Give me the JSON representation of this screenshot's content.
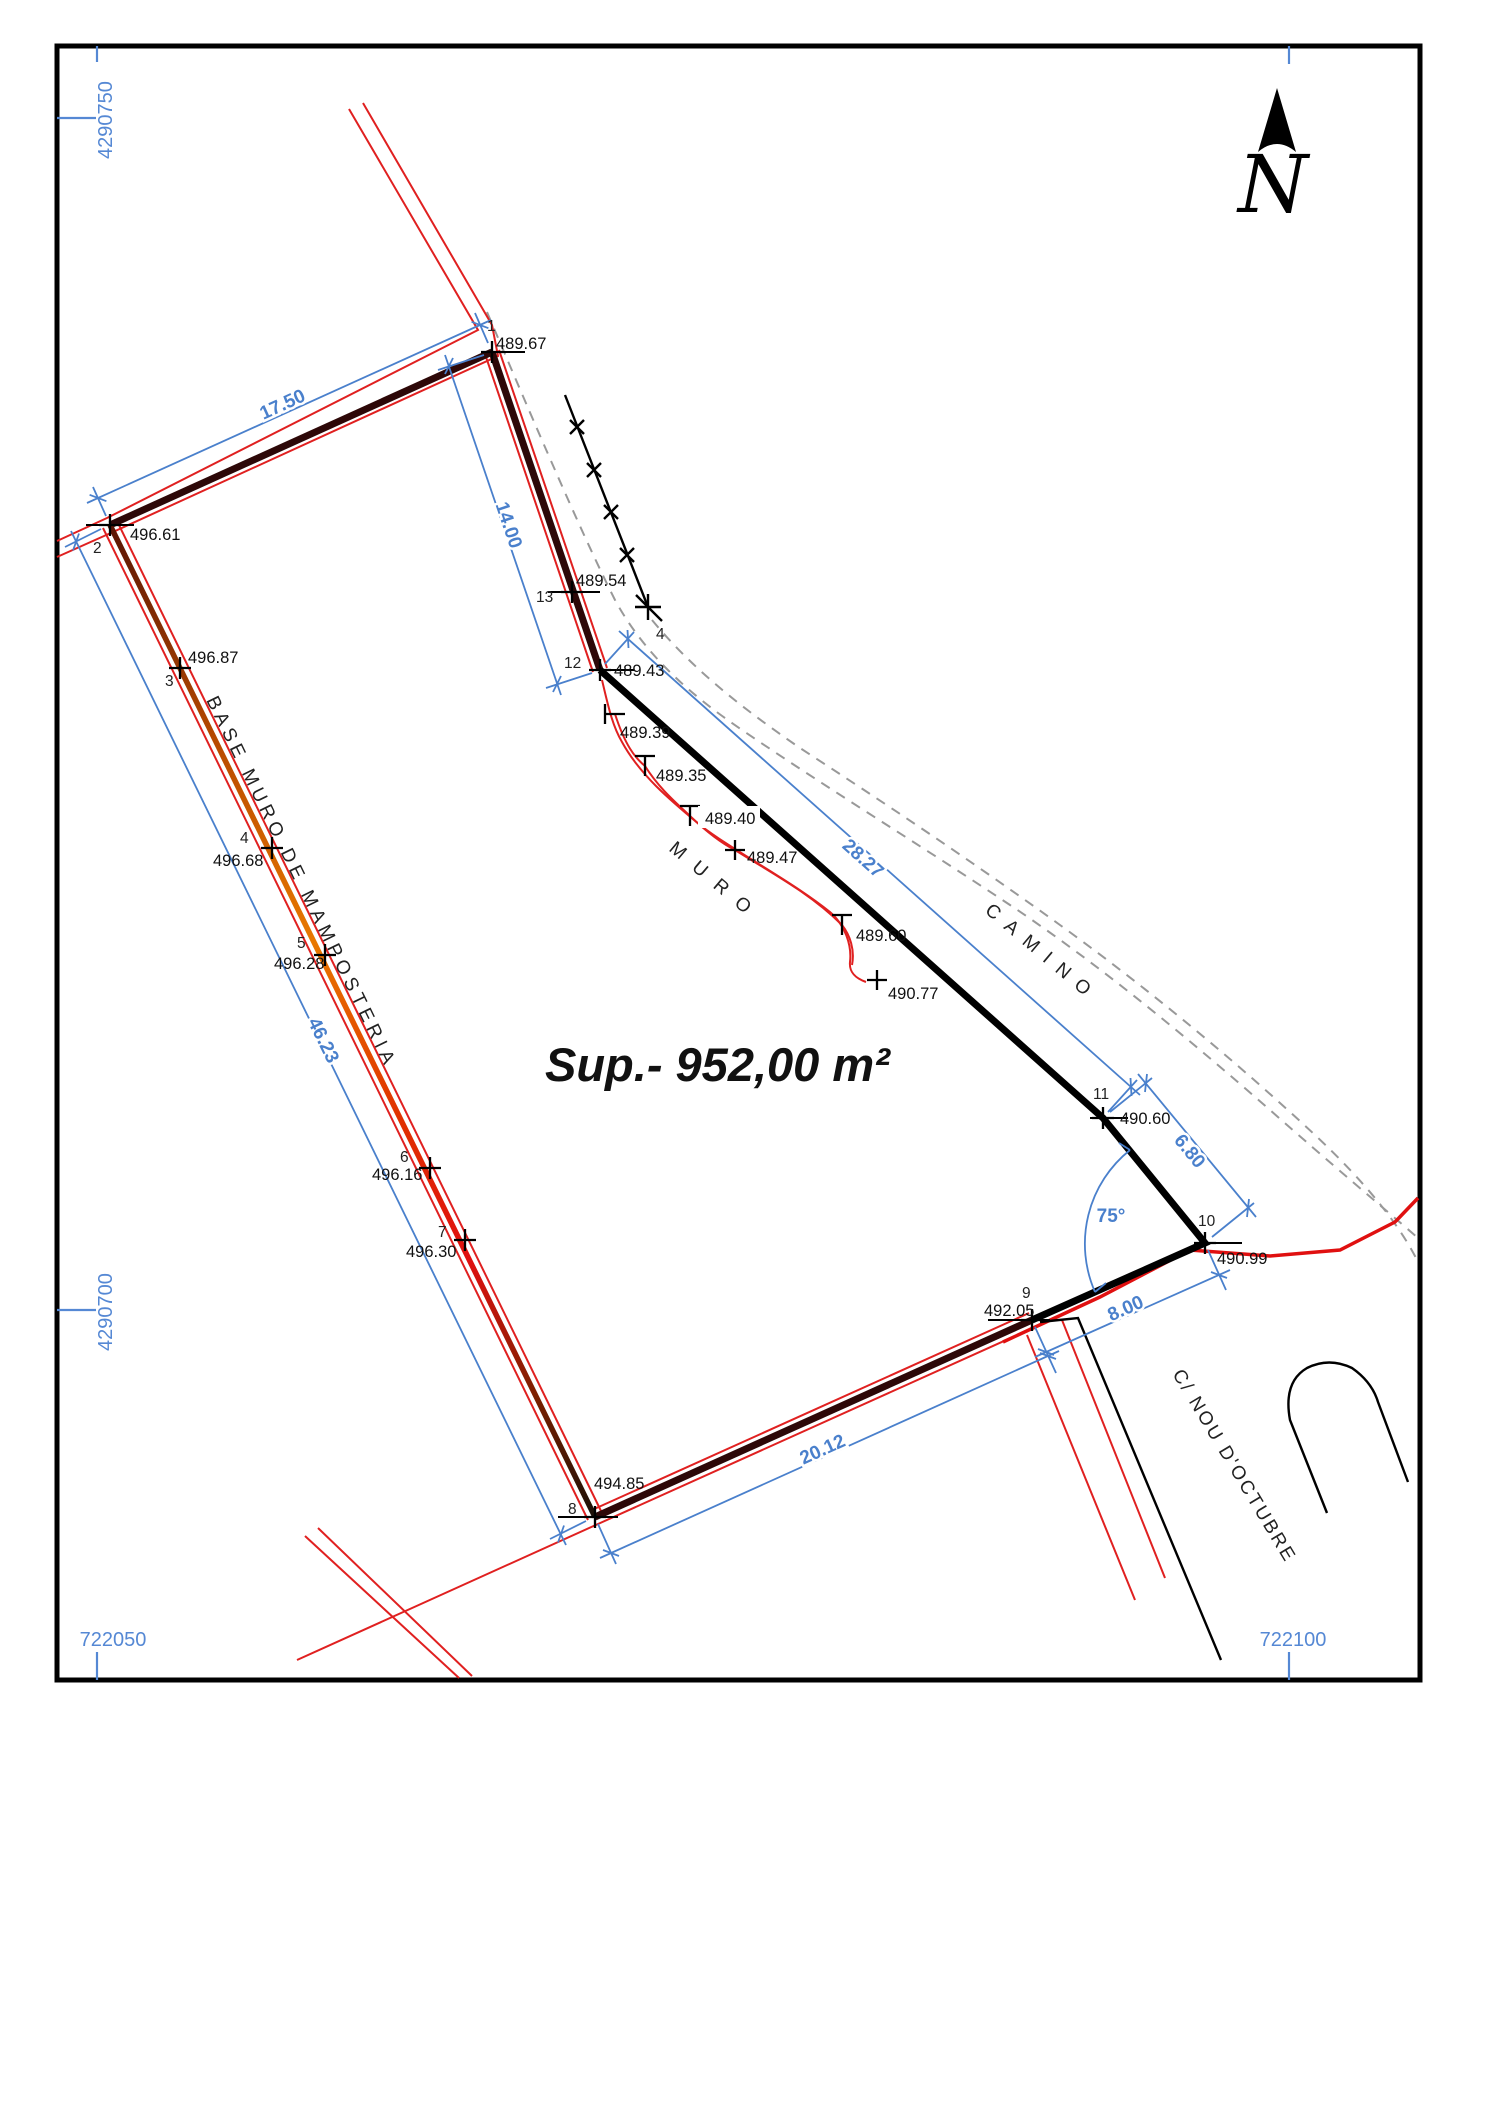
{
  "document": {
    "type": "topographic-survey-plot-plan"
  },
  "grid": {
    "northing_top": "4290750",
    "northing_bottom": "4290700",
    "easting_left": "722050",
    "easting_right": "722100"
  },
  "north_arrow": {
    "label": "N"
  },
  "area": {
    "label": "Sup.- 952,00 m²"
  },
  "labels": {
    "base_muro": "BASE MURO DE MAMPOSTERIA",
    "muro": "MURO",
    "camino": "CAMINO",
    "street": "C/ NOU D'OCTUBRE",
    "angle": "75°"
  },
  "dims": [
    {
      "label": "17.50"
    },
    {
      "label": "14.00"
    },
    {
      "label": "46.23"
    },
    {
      "label": "20.12"
    },
    {
      "label": "8.00"
    },
    {
      "label": "28.27"
    },
    {
      "label": "6.80"
    }
  ],
  "points": [
    {
      "id": "1",
      "elev": "489.67"
    },
    {
      "id": "2",
      "elev": "496.61"
    },
    {
      "id": "3",
      "elev": "496.87"
    },
    {
      "id": "4",
      "elev": "496.68"
    },
    {
      "id": "5",
      "elev": "496.28"
    },
    {
      "id": "6",
      "elev": "496.16"
    },
    {
      "id": "7",
      "elev": "496.30"
    },
    {
      "id": "8",
      "elev": "494.85"
    },
    {
      "id": "9",
      "elev": "492.05"
    },
    {
      "id": "10",
      "elev": "490.99"
    },
    {
      "id": "11",
      "elev": "490.60"
    },
    {
      "id": "12",
      "elev": "489.43"
    },
    {
      "id": "13",
      "elev": "489.54"
    }
  ],
  "fence_point": {
    "id": "4"
  },
  "spots": [
    {
      "elev": "489.39"
    },
    {
      "elev": "489.35"
    },
    {
      "elev": "489.40"
    },
    {
      "elev": "489.47"
    },
    {
      "elev": "489.60"
    },
    {
      "elev": "490.77"
    }
  ],
  "colors": {
    "dimension_blue": "#4a80cc",
    "grid_blue": "#5588d4",
    "thin_red": "#e02020",
    "road_red": "#e01010",
    "wall_maroon": "#2d0808",
    "wall_orange": "#e87800",
    "camino_gray": "#999999",
    "line_black": "#000000"
  }
}
